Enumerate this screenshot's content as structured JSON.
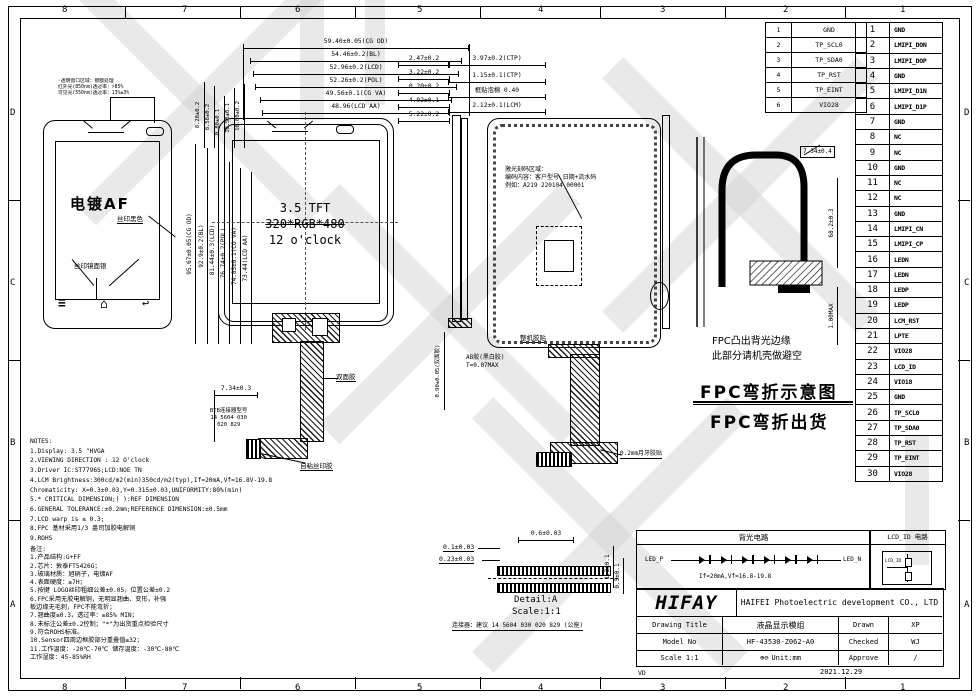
{
  "sheet": {
    "zones_top": [
      "8",
      "7",
      "6",
      "5",
      "4",
      "3",
      "2",
      "1"
    ],
    "zones_bottom": [
      "8",
      "7",
      "6",
      "5",
      "4",
      "3",
      "2",
      "1"
    ],
    "zones_left": [
      "D",
      "C",
      "B",
      "A"
    ],
    "zones_right": [
      "D",
      "C",
      "B",
      "A"
    ],
    "vd_label": "VD",
    "date": "2021.12.29"
  },
  "tp_connector_table": {
    "rows": [
      {
        "pin": "1",
        "signal": "GND"
      },
      {
        "pin": "2",
        "signal": "TP_SCL0"
      },
      {
        "pin": "3",
        "signal": "TP_SDA0"
      },
      {
        "pin": "4",
        "signal": "TP_RST"
      },
      {
        "pin": "5",
        "signal": "TP_EINT"
      },
      {
        "pin": "6",
        "signal": "VIO28"
      }
    ]
  },
  "pin_table": {
    "rows": [
      {
        "pin": "1",
        "signal": "GND"
      },
      {
        "pin": "2",
        "signal": "LMIPI_DON"
      },
      {
        "pin": "3",
        "signal": "LMIPI_DOP"
      },
      {
        "pin": "4",
        "signal": "GND"
      },
      {
        "pin": "5",
        "signal": "LMIPI_D1N"
      },
      {
        "pin": "6",
        "signal": "LMIPI_D1P"
      },
      {
        "pin": "7",
        "signal": "GND"
      },
      {
        "pin": "8",
        "signal": "NC"
      },
      {
        "pin": "9",
        "signal": "NC"
      },
      {
        "pin": "10",
        "signal": "GND"
      },
      {
        "pin": "11",
        "signal": "NC"
      },
      {
        "pin": "12",
        "signal": "NC"
      },
      {
        "pin": "13",
        "signal": "GND"
      },
      {
        "pin": "14",
        "signal": "LMIPI_CN"
      },
      {
        "pin": "15",
        "signal": "LMIPI_CP"
      },
      {
        "pin": "16",
        "signal": "LEDN"
      },
      {
        "pin": "17",
        "signal": "LEDN"
      },
      {
        "pin": "18",
        "signal": "LEDP"
      },
      {
        "pin": "19",
        "signal": "LEDP"
      },
      {
        "pin": "20",
        "signal": "LCM_RST"
      },
      {
        "pin": "21",
        "signal": "LPTE"
      },
      {
        "pin": "22",
        "signal": "VIO28"
      },
      {
        "pin": "23",
        "signal": "LCD_ID"
      },
      {
        "pin": "24",
        "signal": "VIO18"
      },
      {
        "pin": "25",
        "signal": "GND"
      },
      {
        "pin": "26",
        "signal": "TP_SCL0"
      },
      {
        "pin": "27",
        "signal": "TP_SDA0"
      },
      {
        "pin": "28",
        "signal": "TP_RST"
      },
      {
        "pin": "29",
        "signal": "TP_EINT"
      },
      {
        "pin": "30",
        "signal": "VIO28"
      }
    ]
  },
  "top_dims": [
    "59.40±0.05(CG OD)",
    "54.46±0.2(BL)",
    "52.96±0.2(LCD)",
    "52.26±0.2(POL)",
    "49.56±0.1(CG VA)",
    "48.96(LCD AA)"
  ],
  "top_right_dims": [
    "2.47±0.2",
    "3.22±0.2",
    "0.20±0.2",
    "4.92±0.1",
    "5.22±0.2"
  ],
  "ctp_stack_dims": [
    "3.97±0.2(CTP)",
    "1.15±0.1(CTP)",
    "框贴泡棉 0.40",
    "2.12±0.1(LCM)"
  ],
  "left_vertical_dims": [
    "95.67±0.05(CG OD)",
    "92.9±0.2(BL)",
    "81.44±0.3(LCD)",
    "76.74±0.2(POL)",
    "74.05±0.1(CG VA)",
    "73.44(LCD AA)"
  ],
  "small_top_dims": [
    "8.28±0.2",
    "8.58±0.2",
    "0.80±0.1",
    "10.55±0.1",
    "10.60±0.2"
  ],
  "front_view": {
    "coating_note_lines": [
      "·透明窗口区域：镀膜处理",
      "红外光(850nm)透过率：>85%",
      "可见光(550nm)透过率：13%±3%"
    ],
    "plating_label": "电镀AF",
    "silk_black": "丝印黑色",
    "silk_silver": "丝印镜面银",
    "nav_icons": {
      "menu": "≡",
      "home": "⌂",
      "back": "↩"
    }
  },
  "display_view": {
    "line1": "3.5 TFT",
    "line2": "320*RGB*480",
    "line3": "12 o'clock"
  },
  "fpc_front": {
    "dim": "7.34±0.3",
    "btb_lines": [
      "BTB连接器型号",
      "14 5604 030",
      "020 829"
    ],
    "tape_label": "双面胶",
    "adhesive_label": "自粘丝印胶"
  },
  "side_view": {
    "tape_dim": "0.90±0.05(双面胶)",
    "frame_tape": "整机胶贴",
    "ab_glue_line1": "AB胶(黑白胶)",
    "ab_glue_line2": "T=0.07MAX"
  },
  "rear_view": {
    "laser_lines": [
      "激光刻码区域：",
      "编码内容：客户型号 日期+流水码",
      "例如：A219 220104 00001"
    ],
    "moon_tape": "0.2mm月牙胶贴"
  },
  "bend_view": {
    "dim": "7.34±0.4",
    "height_dim": "68.2±0.3",
    "thickness_dim": "1.00MAX",
    "note_line1": "FPC凸出背光边缘",
    "note_line2": "此部分请机壳做避空",
    "title1": "FPC弯折示意图",
    "title2": "FPC弯折出货"
  },
  "notes_en": [
    "NOTES:",
    "1.Display: 3.5 \"HVGA",
    "2.VIEWING DIRECTION : 12 O'clock",
    "3.Driver IC:ST7796S;LCD:NOE TN",
    "4.LCM Brightness:300cd/m2(min)350cd/m2(typ),If=20mA,Vf=16.8V-19.8",
    "  Chromaticity: X=0.3±0.03,Y=0.315±0.03,UNIFORMITY:80%(min)",
    "5.* CRITICAL DIMENSION;( ):REF DIMENSION",
    "6.GENERAL TOLERANCE:±0.2mm;REFERENCE DIMENSION:±0.5mm",
    "7.LCD warp is ≤ 0.3;",
    "8.FPC 基材采用1/3 盎司加胶电解铜",
    "9.ROHS"
  ],
  "remarks_cn": [
    "备注:",
    "1.产品结构:G+FF",
    "2.芯片：敦泰FT5426G；",
    "3.玻璃材质：旭硝子，电镀AF",
    "4.表面硬度：≥7H；",
    "5.按键 LOGO丝印粗细公差±0.05，位置公差±0.2",
    "6.FPC采用无胶电解铜，无明显翘曲、变形，补强",
    "板边缘无毛刺，FPC不能弯折；",
    "7.翘曲度≤0.3，透过率：≥85% MIN；",
    "8.未标注公差±0.2控制；\"*\"为出货重点检验尺寸",
    "9.符合ROHS标准。",
    "10.Sensor四周边框胶部分重叠值≥32；",
    "11.工作温度：-20℃-70℃ 储存温度：-30℃-80℃",
    "工作湿度：45-85%RH"
  ],
  "detail_a": {
    "dim_top": "0.6±0.03",
    "dim_left1": "0.1±0.03",
    "dim_left2": "0.23±0.03",
    "dim_right1": "1.3±0.1",
    "dim_right2": "0.5±0.1",
    "label": "Detail:A",
    "scale": "Scale:1:1",
    "connector_note": "连接器：建议 14 5604 030 020 829 (公座)"
  },
  "backlight": {
    "title": "背光电路",
    "left": "LED_P",
    "right": "LED_N",
    "spec": "If=20mA,Vf=16.8-19.8"
  },
  "lcd_id": {
    "title": "LCD_ID 电路",
    "label": "LCD_ID"
  },
  "title_block": {
    "logo": "HIFAY",
    "company": "HAIFEI Photoelectric development CO., LTD",
    "drawing_title_label": "Drawing Title",
    "drawing_title_value": "液晶显示模组",
    "model_label": "Model No",
    "model_value": "HF-43530-Z062-A0",
    "scale_label": "Scale 1:1",
    "projection_symbol": "⊕⊖",
    "unit_label": "Unit:mm",
    "drawn_label": "Drawn",
    "drawn_value": "XP",
    "checked_label": "Checked",
    "checked_value": "WJ",
    "approve_label": "Approve",
    "approve_value": "/"
  }
}
